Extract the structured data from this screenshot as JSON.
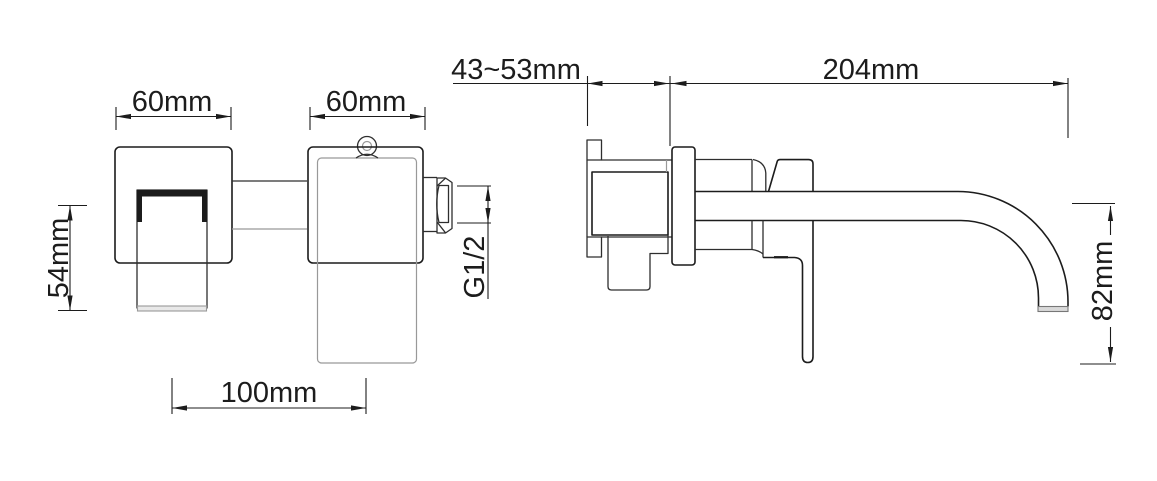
{
  "colors": {
    "background": "#ffffff",
    "line": "#1c1c1c",
    "secondary_line": "#999999"
  },
  "views": {
    "front": {
      "dimensions": {
        "plate_left_width": "60mm",
        "plate_right_width": "60mm",
        "handle_height": "54mm",
        "plate_spacing": "100mm",
        "inlet_thread": "G1/2"
      }
    },
    "side": {
      "dimensions": {
        "wall_depth_range": "43~53mm",
        "spout_reach": "204mm",
        "spout_height": "82mm"
      }
    }
  }
}
